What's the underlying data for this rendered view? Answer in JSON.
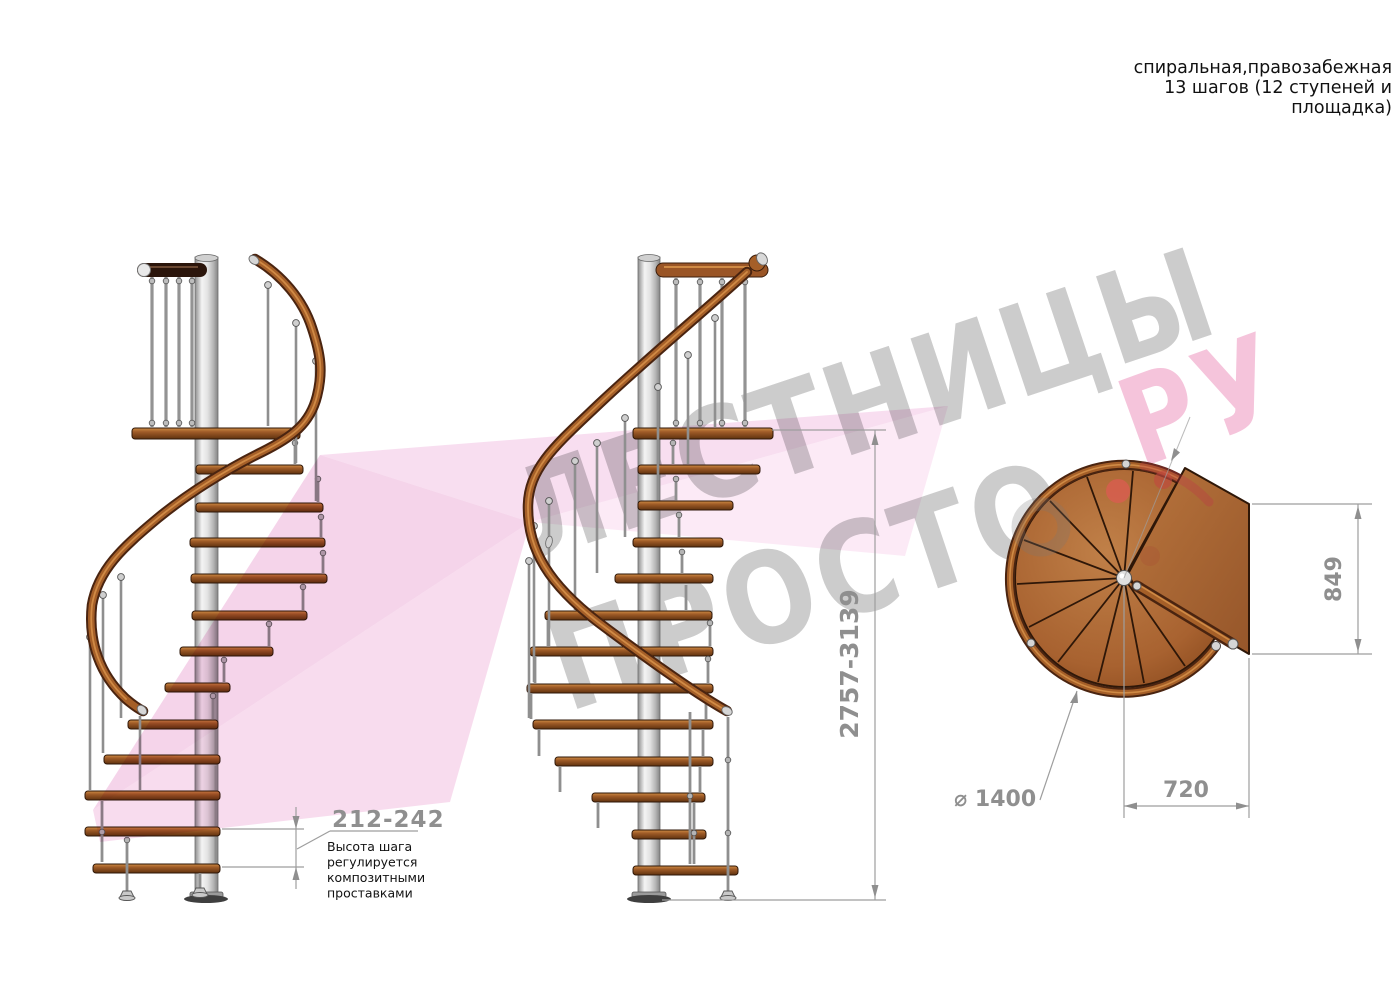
{
  "title_block": {
    "line1": "спиральная,правозабежная",
    "line2": "13 шагов (12 ступеней и",
    "line3": "площадка)"
  },
  "watermark": {
    "word1": "ЛЕСТНИЦЫ",
    "word2": "ПРОСТО",
    "word3": "РУ"
  },
  "dimensions": {
    "step_height": "212-242",
    "step_height_note": [
      "Высота шага",
      "регулируется",
      "композитными",
      "проставками"
    ],
    "total_height": "2757-3139",
    "landing_depth": "849",
    "landing_width": "720",
    "diameter": "⌀ 1400"
  },
  "colors": {
    "wood": "#a05c28",
    "wood_light": "#c9873f",
    "handrail": "#8a4a1e",
    "dark_top_rail": "#2b150b",
    "metal": "#d9d9d9",
    "dimension_gray": "#8f8f8f",
    "watermark_gray": "#cacaca",
    "watermark_pink": "#f5c2da",
    "watermark_red_dot": "#d95c50",
    "ribbon_pink": "#f2c3e3",
    "text_black": "#111111"
  }
}
